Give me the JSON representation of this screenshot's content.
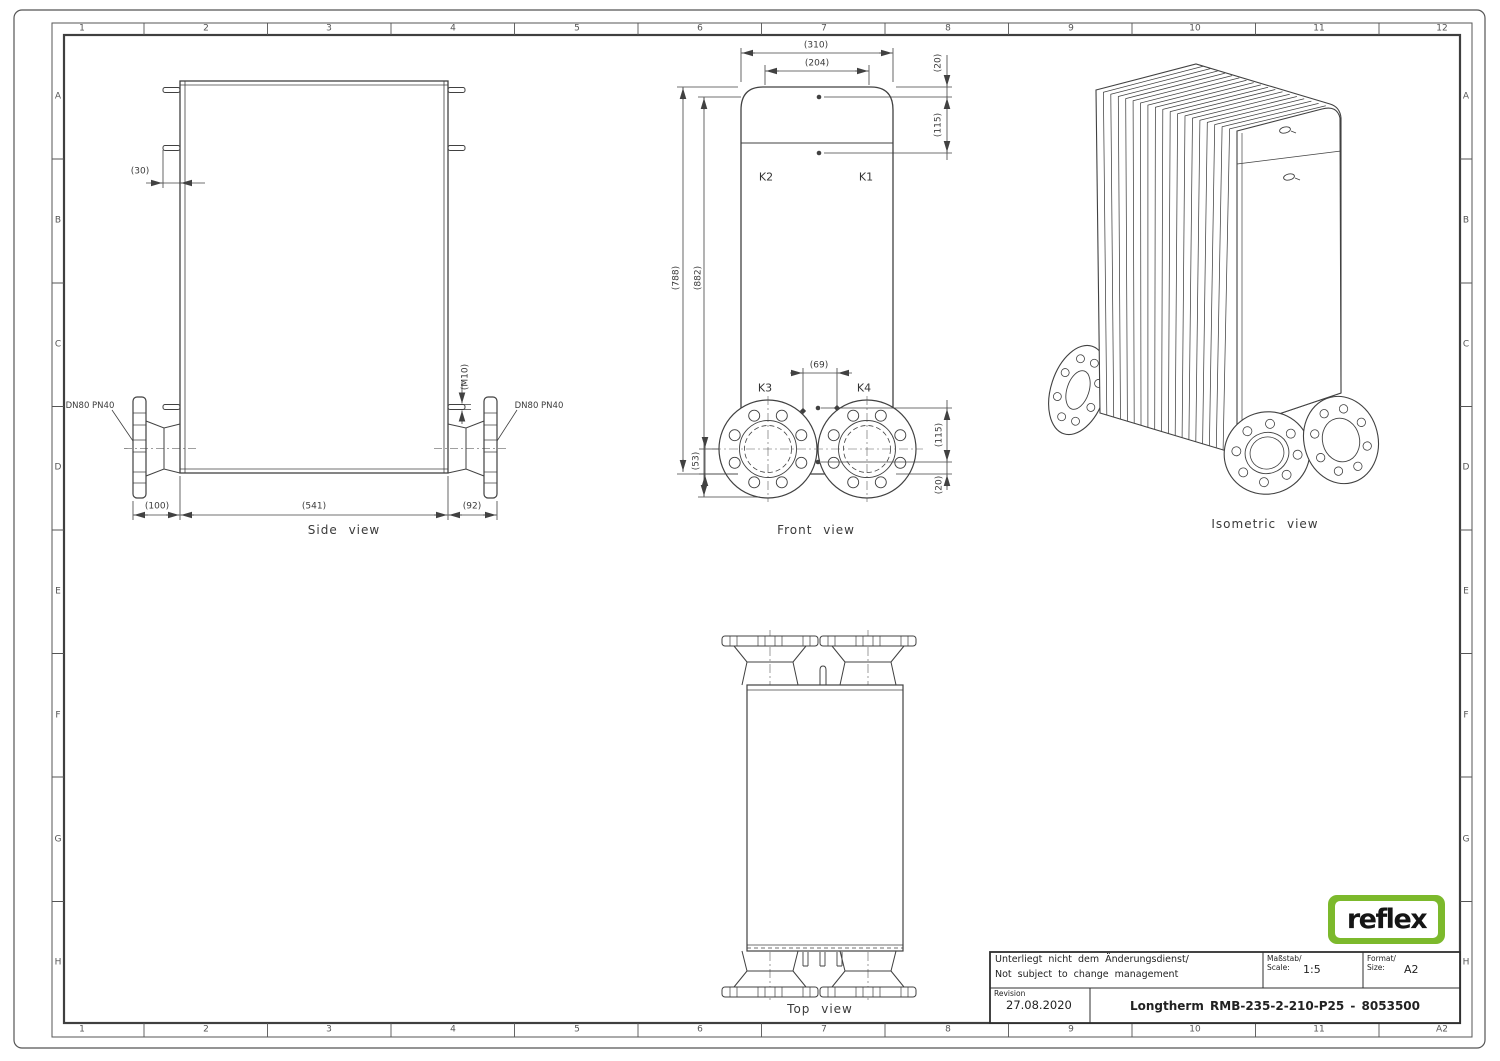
{
  "frame": {
    "top_cells": [
      "1",
      "2",
      "3",
      "4",
      "5",
      "6",
      "7",
      "8",
      "9",
      "10",
      "11",
      "12"
    ],
    "bottom_cells": [
      "1",
      "2",
      "3",
      "4",
      "5",
      "6",
      "7",
      "8",
      "9",
      "10",
      "11",
      "A2"
    ],
    "left_cells": [
      "A",
      "B",
      "C",
      "D",
      "E",
      "F",
      "G",
      "H"
    ],
    "right_cells": [
      "A",
      "B",
      "C",
      "D",
      "E",
      "F",
      "G",
      "H"
    ]
  },
  "side_view": {
    "caption": "Side view",
    "dim_stud": "(30)",
    "dim_thread": "(M10)",
    "dn_left": "DN80 PN40",
    "dn_right": "DN80 PN40",
    "dim_100": "(100)",
    "dim_541": "(541)",
    "dim_92": "(92)"
  },
  "front_view": {
    "caption": "Front view",
    "k1": "K1",
    "k2": "K2",
    "k3": "K3",
    "k4": "K4",
    "dim_310": "(310)",
    "dim_204": "(204)",
    "dim_20_top": "(20)",
    "dim_115_top": "(115)",
    "dim_788": "(788)",
    "dim_882": "(882)",
    "dim_69": "(69)",
    "dim_53": "(53)",
    "dim_115_bottom": "(115)",
    "dim_20_bottom": "(20)"
  },
  "top_view": {
    "caption": "Top view"
  },
  "iso_view": {
    "caption": "Isometric view"
  },
  "title_block": {
    "note_line1": "Unterliegt nicht dem Änderungsdienst/",
    "note_line2": "Not subject to change management",
    "scale_label_de": "Maßstab/",
    "scale_label_en": "Scale:",
    "scale_value": "1:5",
    "format_label_de": "Format/",
    "format_label_en": "Size:",
    "format_value": "A2",
    "revision_label": "Revision",
    "revision_date": "27.08.2020",
    "title": "Longtherm RMB-235-2-210-P25 - 8053500"
  },
  "logo": {
    "text": "reflex",
    "green": "#7cb92c"
  },
  "colors": {
    "line": "#414141",
    "text": "#3a3a3a"
  }
}
